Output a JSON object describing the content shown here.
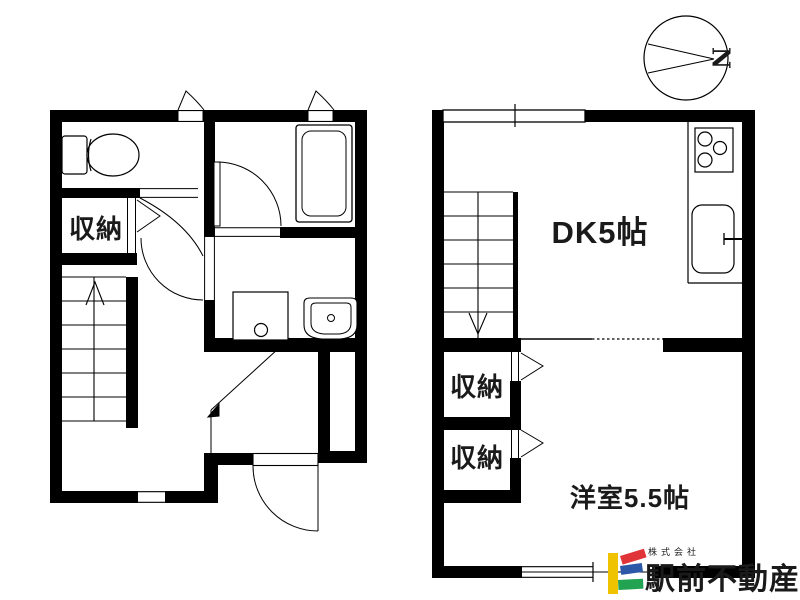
{
  "page": {
    "background": "#ffffff",
    "wall_color": "#000000"
  },
  "floorplan": {
    "first_floor": {
      "closet_label": "収納"
    },
    "second_floor": {
      "dk_label": "DK5帖",
      "western_room_label": "洋室5.5帖",
      "closet_upper_label": "収納",
      "closet_lower_label": "収納"
    },
    "compass": {
      "north_label": "N"
    }
  },
  "logo": {
    "company_type": "株式会社",
    "company_name": "駅前不動産",
    "colors": {
      "yellow": "#f0c300",
      "red": "#e13438",
      "blue": "#2d58a7",
      "green": "#22a351",
      "text": "#7d7d7d",
      "type_text": "#8a8a8a"
    }
  }
}
